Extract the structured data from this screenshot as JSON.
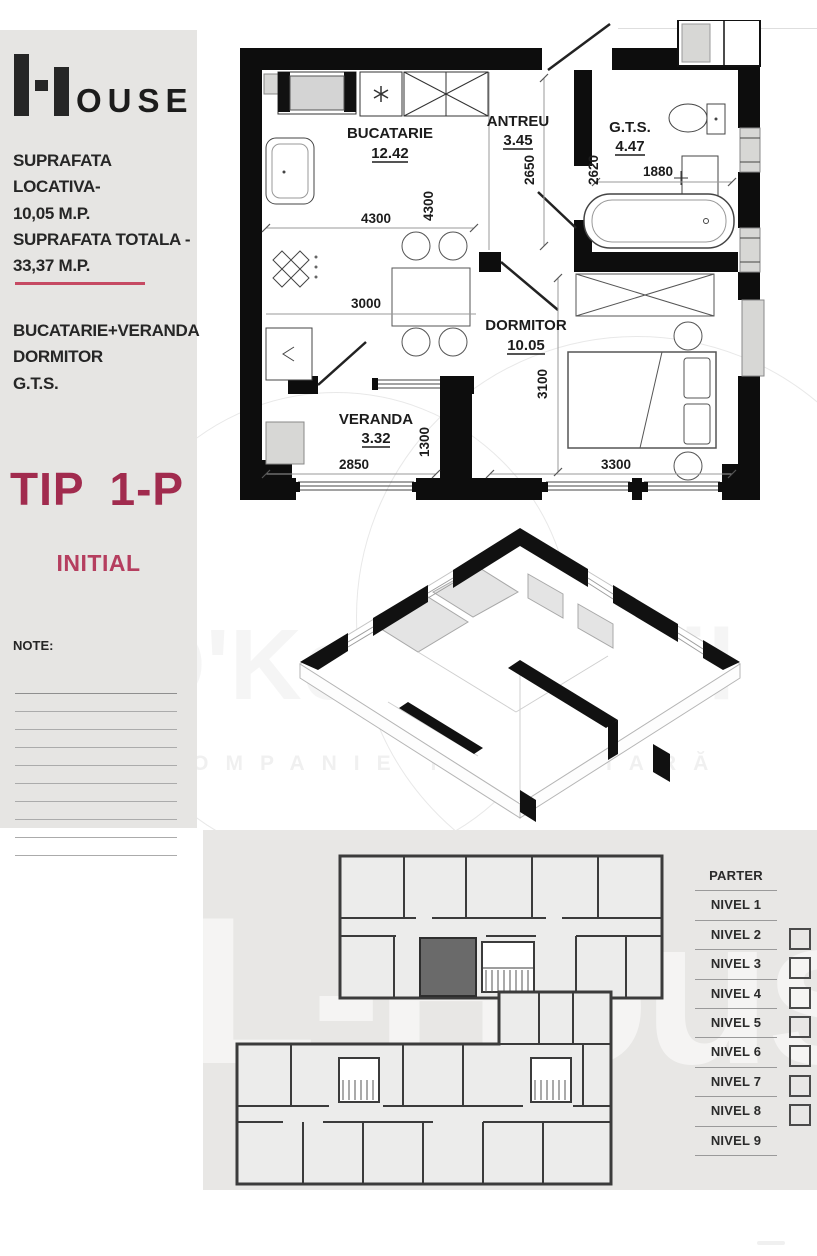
{
  "logo": {
    "brand": "L-House",
    "rest": "OUSE"
  },
  "sidebar": {
    "area_line1": "SUPRAFATA LOCATIVA-",
    "area_line2": "10,05 M.P.",
    "area_line3": "SUPRAFATA TOTALA -",
    "area_line4": "33,37 M.P.",
    "room_line1": "BUCATARIE+VERANDA",
    "room_line2": "DORMITOR",
    "room_line3": "G.T.S.",
    "type_label": "TIP  1-P",
    "phase_label": "INITIAL",
    "note_label": "NOTE:",
    "note_line_count": 10
  },
  "floor_plan": {
    "rooms": [
      {
        "name": "BUCATARIE",
        "area": "12.42"
      },
      {
        "name": "ANTREU",
        "area": "3.45"
      },
      {
        "name": "G.T.S.",
        "area": "4.47"
      },
      {
        "name": "DORMITOR",
        "area": "10.05"
      },
      {
        "name": "VERANDA",
        "area": "3.32"
      }
    ],
    "dims": {
      "kitchen_w": "4300",
      "kitchen_h": "4300",
      "kitchen_inner": "3000",
      "antreu_h": "2650",
      "gts_h": "2620",
      "gts_w": "1880",
      "dorm_h": "3100",
      "dorm_w": "3300",
      "veranda_w": "2850",
      "veranda_h": "1300"
    }
  },
  "watermark": {
    "title": "O'Key Imobil",
    "subtitle": "COMPANIE IMOBILIARĂ",
    "bottom_brand": "L-House"
  },
  "levels": {
    "items": [
      {
        "label": "PARTER",
        "checkbox": false
      },
      {
        "label": "NIVEL 1",
        "checkbox": false
      },
      {
        "label": "NIVEL 2",
        "checkbox": true
      },
      {
        "label": "NIVEL 3",
        "checkbox": true
      },
      {
        "label": "NIVEL 4",
        "checkbox": true
      },
      {
        "label": "NIVEL 5",
        "checkbox": true
      },
      {
        "label": "NIVEL 6",
        "checkbox": true
      },
      {
        "label": "NIVEL 7",
        "checkbox": true
      },
      {
        "label": "NIVEL 8",
        "checkbox": true
      },
      {
        "label": "NIVEL 9",
        "checkbox": false
      }
    ]
  },
  "colors": {
    "accent_line": "#c64a63",
    "type_text": "#a12b4e",
    "phase_text": "#b53e5f",
    "sidebar_bg": "#e6e5e3",
    "bottom_bg": "#e8e7e5",
    "highlight_unit": "#6a6a6a",
    "wall": "#0d0d0d"
  }
}
